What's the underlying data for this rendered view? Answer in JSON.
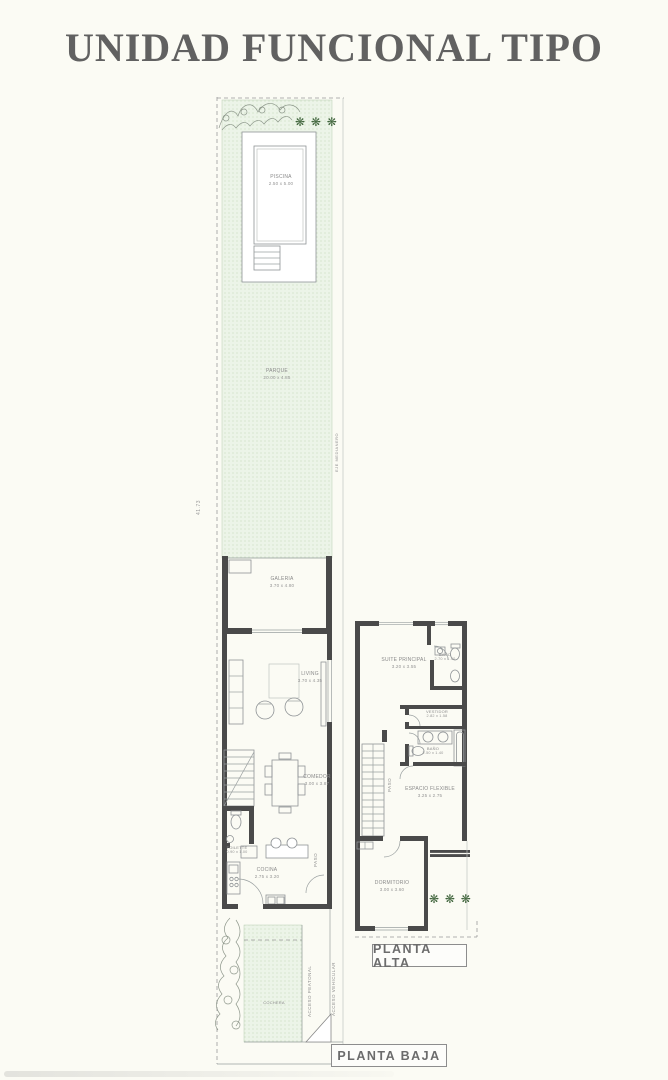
{
  "title": "UNIDAD FUNCIONAL TIPO",
  "planta_baja": {
    "tag": "PLANTA BAJA",
    "rooms": {
      "piscina": {
        "name": "PISCINA",
        "dims": "2.50 x 5.00"
      },
      "parque": {
        "name": "PARQUE",
        "dims": "20.00 x 4.85"
      },
      "galeria": {
        "name": "GALERIA",
        "dims": "3.70 x 4.80"
      },
      "living": {
        "name": "LIVING",
        "dims": "3.70 x 4.35"
      },
      "comedor": {
        "name": "COMEDOR",
        "dims": "3.00 x 3.87"
      },
      "toilette": {
        "name": "TOILETTE",
        "dims": "0.90 x 1.00"
      },
      "cocina": {
        "name": "COCINA",
        "dims": "2.75 x 3.20"
      },
      "cochera": {
        "name": "COCHERA"
      }
    },
    "annotations": {
      "paso": "PASO",
      "acceso_peatonal": "ACCESO PEATONAL",
      "acceso_vehicular": "ACCESO VEHICULAR",
      "eje": "EJE MEDIANERO",
      "total_length": "41.73"
    }
  },
  "planta_alta": {
    "tag": "PLANTA ALTA",
    "rooms": {
      "suite": {
        "name": "SUITE PRINCIPAL",
        "dims": "3.20 x 3.55"
      },
      "banio_suite": {
        "name": "BAÑO",
        "dims": "2.70 x 1.40"
      },
      "vestidor": {
        "name": "VESTIDOR",
        "dims": "2.82 x 1.58"
      },
      "banio": {
        "name": "BAÑO",
        "dims": "2.50 x 1.40"
      },
      "espacio_flexible": {
        "name": "ESPACIO FLEXIBLE",
        "dims": "3.25 x 2.75"
      },
      "dormitorio": {
        "name": "DORMITORIO",
        "dims": "3.00 x 3.60"
      }
    },
    "annotations": {
      "paso": "PASO"
    }
  },
  "decor": {
    "tree_row": "❋ ❋ ❋"
  },
  "colors": {
    "wall": "#4a4a4a",
    "garden_fill": "#ecf4e8",
    "garden_dot": "#c9ddc1",
    "tree_green": "#3f653c",
    "label_gray": "#8a8a8a",
    "title_gray": "#616161"
  }
}
